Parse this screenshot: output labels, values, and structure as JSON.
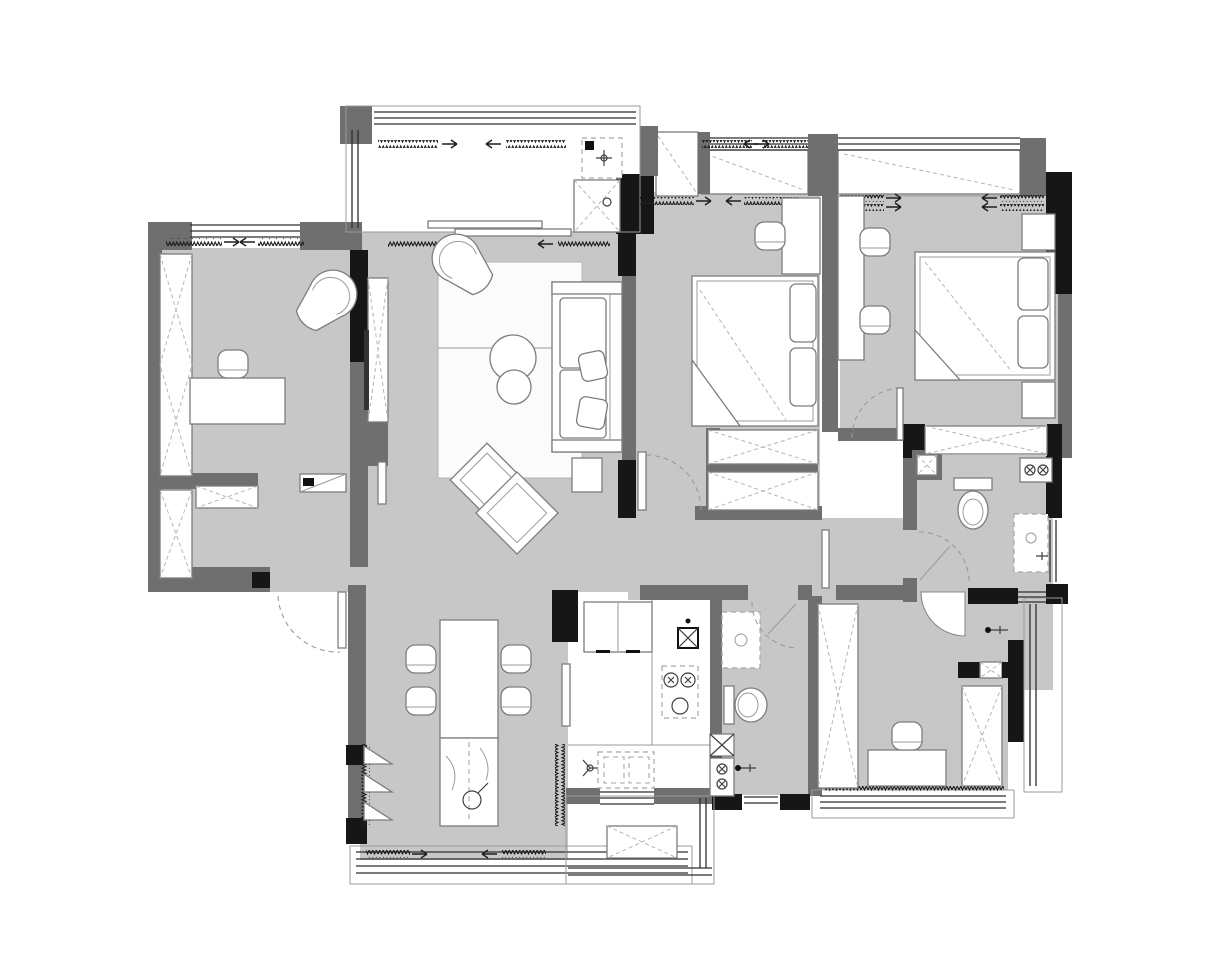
{
  "palette": {
    "bg": "#ffffff",
    "floor": "#c7c7c7",
    "wall": "#6f6f6f",
    "wall_black": "#161616",
    "furniture_fill": "#ffffff",
    "furniture_stroke": "#7d7d7d",
    "detail": "#3f3f3f",
    "dash": "#a6a6a6",
    "rug": "#fbfbfb",
    "glass": "#2e2e2e"
  },
  "plan": {
    "drawing_type": "Monochrome apartment floor plan, top view, gray floor fill, no text labels",
    "regions": [
      {
        "id": "laundry-balcony",
        "features": [
          "washing-machine-dashed",
          "floor-drain",
          "glazed-window-band"
        ]
      },
      {
        "id": "study",
        "features": [
          "desk",
          "task-chair",
          "fan-armchair",
          "wardrobes-x",
          "window-band",
          "shoe-bench"
        ]
      },
      {
        "id": "living-room",
        "features": [
          "sofa",
          "rug",
          "two-round-coffee-tables",
          "fan-armchair",
          "tv-cabinet",
          "side-table",
          "floor-cushions",
          "balcony-sliding-door"
        ]
      },
      {
        "id": "dining-room",
        "features": [
          "dining-table",
          "four-chairs",
          "island-with-sink-faucet",
          "triangle-wall-shelves",
          "window-band",
          "entry-door-arc"
        ]
      },
      {
        "id": "kitchen",
        "features": [
          "fridge-double-door",
          "gas-hob-dashed",
          "double-sink-dashed",
          "flue-shaft-x",
          "counter",
          "window",
          "sliding-door-leaf"
        ]
      },
      {
        "id": "bedroom-1",
        "features": [
          "double-bed",
          "desk",
          "chair",
          "two-wardrobes-x",
          "bay-window",
          "door-arc"
        ]
      },
      {
        "id": "master-bedroom",
        "features": [
          "double-bed",
          "two-nightstands",
          "dresser-desk",
          "two-chairs",
          "wardrobe-x",
          "bay-window",
          "door-arc"
        ]
      },
      {
        "id": "master-bathroom",
        "features": [
          "toilet",
          "vanity-dashed",
          "shower-faucet",
          "double-socket-symbol",
          "window",
          "door-arc",
          "shaft-x"
        ]
      },
      {
        "id": "guest-bathroom",
        "features": [
          "toilet",
          "vanity-dashed",
          "shower-faucet",
          "double-socket-symbol",
          "shaft-x",
          "door-arc"
        ]
      },
      {
        "id": "study-2",
        "features": [
          "desk",
          "chair",
          "two-wardrobes-x",
          "window-band",
          "fan-door"
        ]
      },
      {
        "id": "south-balcony",
        "features": [
          "ac-platform-x",
          "window-band"
        ]
      },
      {
        "id": "east-balcony",
        "features": [
          "window-band"
        ]
      }
    ],
    "annotation_symbols": [
      "zigzag-window-vent-marks",
      "direction-arrows",
      "dashed-door-swing-arcs",
      "x-cross-cabinet-marks",
      "circled-x-socket-marks"
    ]
  }
}
